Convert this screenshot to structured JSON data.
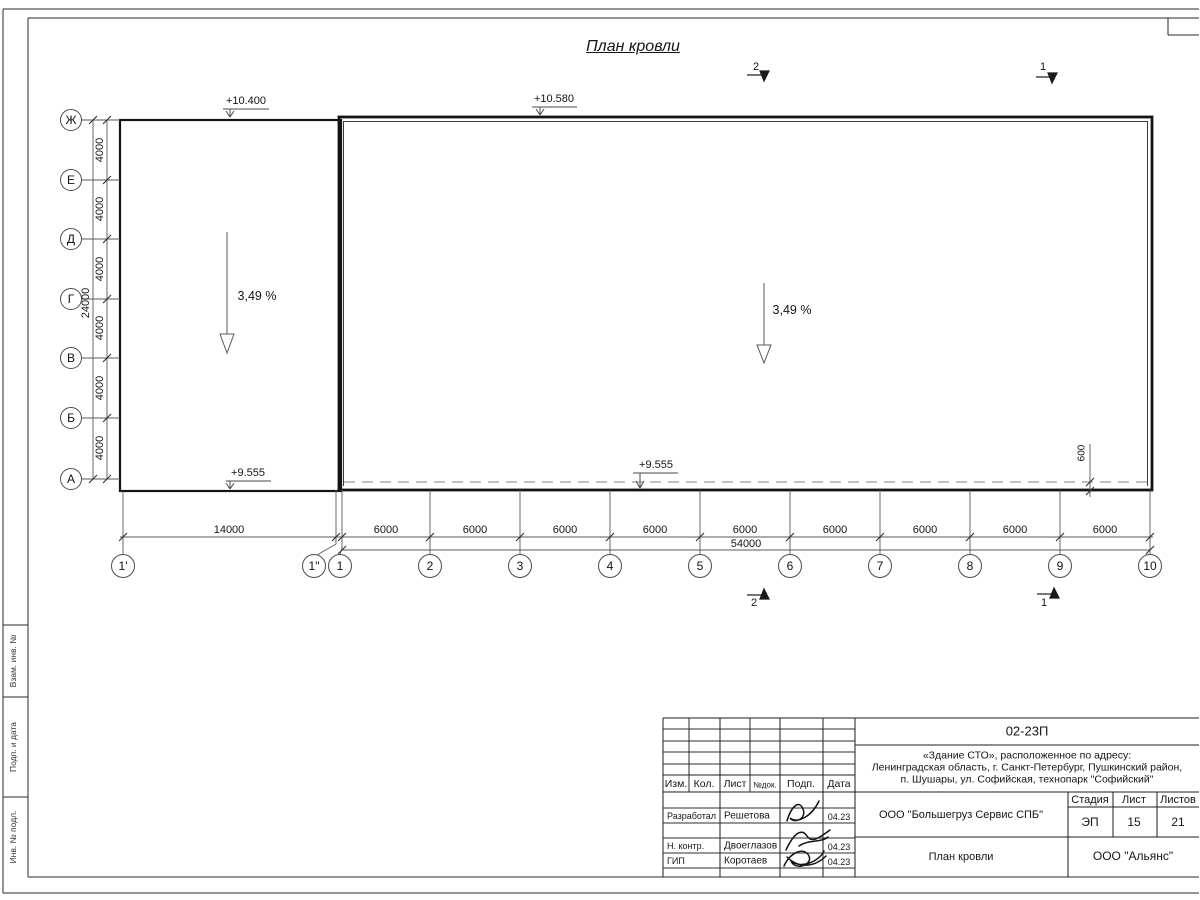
{
  "page": {
    "title": "План кровли"
  },
  "frame_strip": {
    "cells": [
      "Взам. инв. №",
      "Подп. и дата",
      "Инв. № подл."
    ]
  },
  "axes": {
    "letters": [
      "Ж",
      "Е",
      "Д",
      "Г",
      "В",
      "Б",
      "А"
    ],
    "numbers": [
      "1'",
      "1\"",
      "1",
      "2",
      "3",
      "4",
      "5",
      "6",
      "7",
      "8",
      "9",
      "10"
    ]
  },
  "dims": {
    "v_bays": [
      "4000",
      "4000",
      "4000",
      "4000",
      "4000",
      "4000"
    ],
    "v_total": "24000",
    "h_first": "14000",
    "h_bays": [
      "6000",
      "6000",
      "6000",
      "6000",
      "6000",
      "6000",
      "6000",
      "6000",
      "6000"
    ],
    "h_total": "54000",
    "edge_offset": "600"
  },
  "elevations": {
    "left_top": "+10.400",
    "right_top": "+10.580",
    "left_bottom": "+9.555",
    "mid_bottom": "+9.555"
  },
  "slopes": {
    "left": "3,49 %",
    "right": "3,49 %"
  },
  "sections": {
    "top_2": "2",
    "top_1": "1",
    "bottom_2": "2",
    "bottom_1": "1"
  },
  "title_block": {
    "doc_number": "02-23П",
    "project_lines": [
      "«Здание СТО», расположенное по адресу:",
      "Ленинградская область, г. Санкт-Петербург, Пушкинский район,",
      "п. Шушары, ул. Софийская, технопарк \"Софийский\""
    ],
    "client": "ООО \"Большегруз Сервис СПБ\"",
    "sheet_name": "План кровли",
    "company": "ООО \"Альянс\"",
    "stage_label": "Стадия",
    "sheet_label": "Лист",
    "sheets_label": "Листов",
    "stage": "ЭП",
    "sheet": "15",
    "sheets": "21",
    "rev_header": [
      "Изм.",
      "Кол.",
      "Лист",
      "№док.",
      "Подп.",
      "Дата"
    ],
    "sign_rows": [
      {
        "role": "Разработал",
        "name": "Решетова",
        "date": "04.23"
      },
      {
        "role": "Н. контр.",
        "name": "Двоеглазов",
        "date": "04.23"
      },
      {
        "role": "ГИП",
        "name": "Коротаев",
        "date": "04.23"
      }
    ]
  }
}
